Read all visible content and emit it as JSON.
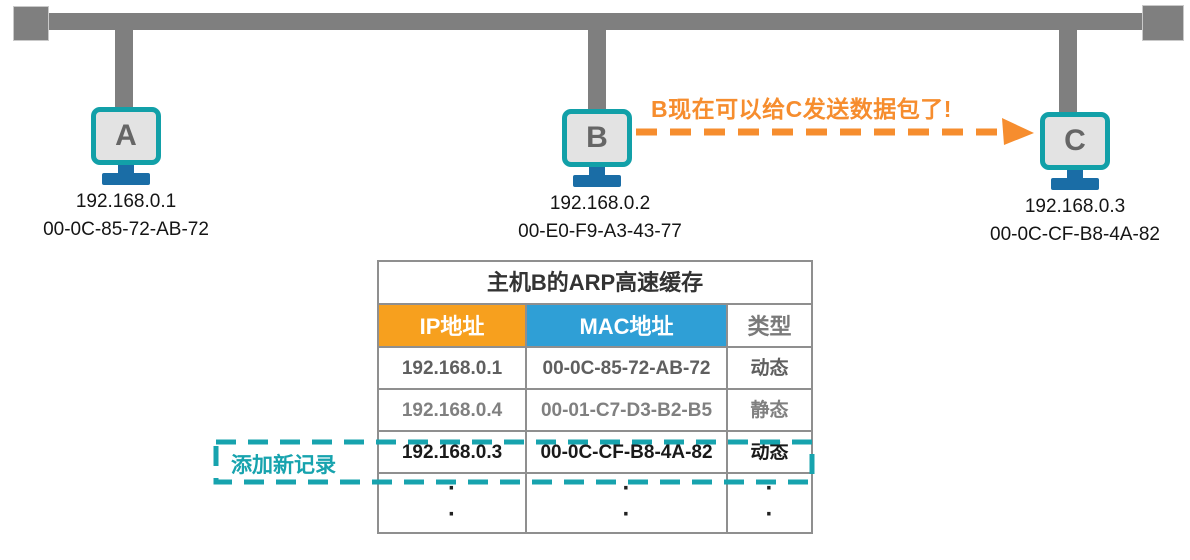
{
  "hosts": [
    {
      "letter": "A",
      "ip": "192.168.0.1",
      "mac": "00-0C-85-72-AB-72"
    },
    {
      "letter": "B",
      "ip": "192.168.0.2",
      "mac": "00-E0-F9-A3-43-77"
    },
    {
      "letter": "C",
      "ip": "192.168.0.3",
      "mac": "00-0C-CF-B8-4A-82"
    }
  ],
  "annotation": {
    "text": "B现在可以给C发送数据包了!"
  },
  "new_record": {
    "label": "添加新记录"
  },
  "arp_table": {
    "title": "主机B的ARP高速缓存",
    "headers": {
      "ip": "IP地址",
      "mac": "MAC地址",
      "type": "类型"
    },
    "rows": [
      {
        "ip": "192.168.0.1",
        "mac": "00-0C-85-72-AB-72",
        "type": "动态"
      },
      {
        "ip": "192.168.0.4",
        "mac": "00-01-C7-D3-B2-B5",
        "type": "静态"
      },
      {
        "ip": "192.168.0.3",
        "mac": "00-0C-CF-B8-4A-82",
        "type": "动态"
      }
    ],
    "ellipsis": "·"
  },
  "colors": {
    "bus_gray": "#7f7f7f",
    "monitor_teal": "#12a0a8",
    "stand_blue": "#1a6da6",
    "accent_orange": "#f68d2e",
    "header_orange": "#f7a01e",
    "header_blue": "#2f9fd6",
    "highlight_teal": "#17a3ae",
    "table_border_gray": "#8f8f8f"
  }
}
